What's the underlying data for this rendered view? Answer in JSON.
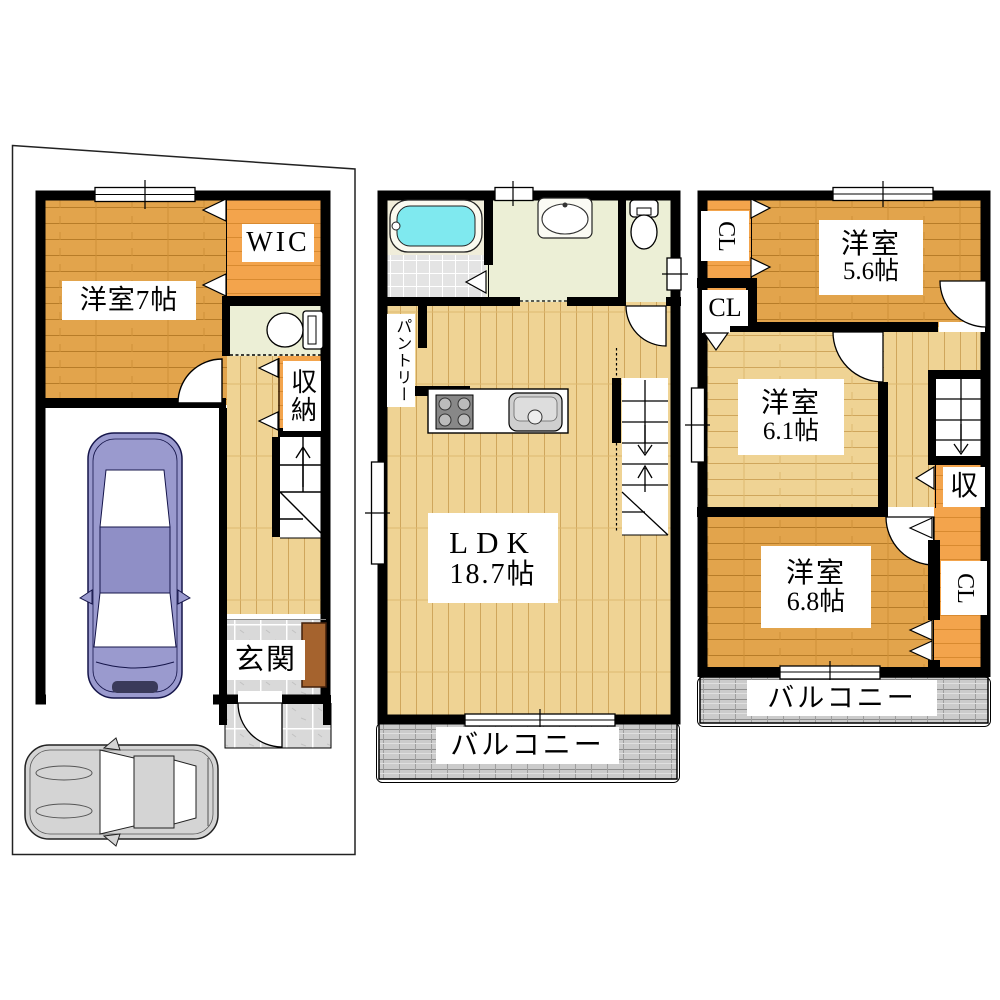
{
  "floor1": {
    "room7_label": "洋室7帖",
    "wic_label": "WIC",
    "storage_label": "収納",
    "entrance_label": "玄関"
  },
  "floor2": {
    "pantry_label": "パントリー",
    "ldk_label": "LDK",
    "ldk_size": "18.7帖",
    "balcony_label": "バルコニー"
  },
  "floor3": {
    "closet_top_label": "CL",
    "closet_mid_label": "CL",
    "closet_right_label": "CL",
    "room56_label": "洋室",
    "room56_size": "5.6帖",
    "room61_label": "洋室",
    "room61_size": "6.1帖",
    "room68_label": "洋室",
    "room68_size": "6.8帖",
    "storage_label": "収",
    "balcony_label": "バルコニー"
  },
  "colors": {
    "wall": "#000000",
    "wood_dark": "#E2A44C",
    "wood_light": "#EFD394",
    "closet_orange": "#F3A44C",
    "sanitary_floor": "#ECEFD6",
    "entry_tile": "#D9D9D9",
    "balcony_gray": "#CBCBCB",
    "bath_water": "#7FE9EF",
    "cabinet_brown": "#A5632E",
    "car_blue": "#9A9ACE",
    "car_gray": "#D4D4D4"
  }
}
